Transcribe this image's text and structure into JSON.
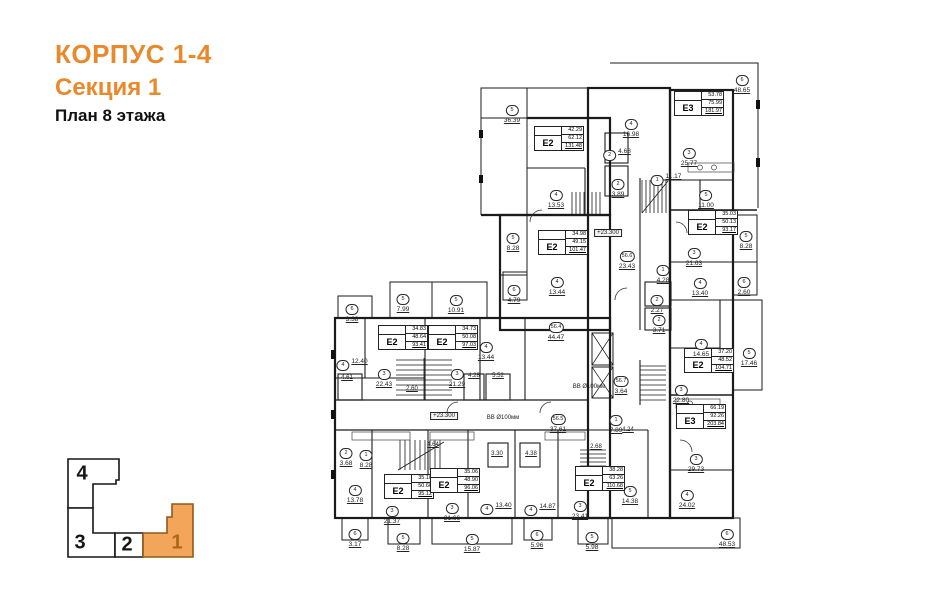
{
  "header": {
    "building": "КОРПУС 1-4",
    "section": "Секция 1",
    "floor": "План 8 этажа"
  },
  "colors": {
    "accent": "#e8892c",
    "key_active_fill": "#f3a55a",
    "key_active_stroke": "#8f5a1b",
    "key_active_text": "#a8691e",
    "line": "#1b1b1b"
  },
  "key_plan": {
    "sections": [
      {
        "label": "4",
        "active": false
      },
      {
        "label": "3",
        "active": false
      },
      {
        "label": "2",
        "active": false
      },
      {
        "label": "1",
        "active": true
      }
    ]
  },
  "plan": {
    "units": [
      {
        "label": "E2",
        "rows": [
          "42.29",
          "62.12",
          "131.48"
        ],
        "x": 534,
        "y": 126
      },
      {
        "label": "E3",
        "rows": [
          "53.78",
          "75.99",
          "181.97"
        ],
        "x": 674,
        "y": 91
      },
      {
        "label": "E2",
        "rows": [
          "35.03",
          "50.13",
          "93.17"
        ],
        "x": 688,
        "y": 210
      },
      {
        "label": "E2",
        "rows": [
          "34.98",
          "49.15",
          "101.47"
        ],
        "x": 538,
        "y": 230
      },
      {
        "label": "E2",
        "rows": [
          "37.20",
          "48.52",
          "104.71"
        ],
        "x": 684,
        "y": 348
      },
      {
        "label": "E3",
        "rows": [
          "66.19",
          "92.26",
          "203.84"
        ],
        "x": 676,
        "y": 404
      },
      {
        "label": "E2",
        "rows": [
          "34.83",
          "48.64",
          "93.41"
        ],
        "x": 378,
        "y": 325
      },
      {
        "label": "E2",
        "rows": [
          "34.73",
          "50.08",
          "97.03"
        ],
        "x": 428,
        "y": 325
      },
      {
        "label": "E2",
        "rows": [
          "35.10",
          "50.66",
          "95.12"
        ],
        "x": 384,
        "y": 474
      },
      {
        "label": "E2",
        "rows": [
          "35.06",
          "48.90",
          "96.06"
        ],
        "x": 430,
        "y": 468
      },
      {
        "label": "E2",
        "rows": [
          "38.28",
          "63.26",
          "110.68"
        ],
        "x": 575,
        "y": 466
      }
    ],
    "labels": [
      {
        "t": "s",
        "n": "5",
        "v": "36.39",
        "x": 512,
        "y": 98
      },
      {
        "t": "s",
        "n": "4",
        "v": "13.53",
        "x": 556,
        "y": 183
      },
      {
        "t": "i",
        "n": "2",
        "v": "4.68",
        "x": 617,
        "y": 143
      },
      {
        "t": "s",
        "n": "2",
        "v": "3.89",
        "x": 618,
        "y": 172
      },
      {
        "t": "s",
        "n": "4",
        "v": "16.98",
        "x": 631,
        "y": 112
      },
      {
        "t": "s",
        "n": "3",
        "v": "25.77",
        "x": 689,
        "y": 141
      },
      {
        "t": "i",
        "n": "1",
        "v": "11.17",
        "x": 666,
        "y": 168
      },
      {
        "t": "s",
        "n": "5",
        "v": "11.00",
        "x": 706,
        "y": 183
      },
      {
        "t": "s",
        "n": "6",
        "v": "48.65",
        "x": 742,
        "y": 68
      },
      {
        "t": "s",
        "n": "5",
        "v": "8.28",
        "x": 746,
        "y": 224
      },
      {
        "t": "s",
        "n": "6",
        "v": "2.60",
        "x": 744,
        "y": 270
      },
      {
        "t": "s",
        "n": "3",
        "v": "21.63",
        "x": 694,
        "y": 241
      },
      {
        "t": "s",
        "n": "4",
        "v": "13.40",
        "x": 700,
        "y": 271
      },
      {
        "t": "s",
        "n": "5",
        "v": "8.28",
        "x": 513,
        "y": 226
      },
      {
        "t": "s",
        "n": "6",
        "v": "4.79",
        "x": 514,
        "y": 278
      },
      {
        "t": "s",
        "n": "4",
        "v": "13.44",
        "x": 557,
        "y": 270
      },
      {
        "t": "s",
        "n": "56.4",
        "v": "44.47",
        "x": 556,
        "y": 315
      },
      {
        "t": "s",
        "n": "56.6",
        "v": "23.43",
        "x": 627,
        "y": 244
      },
      {
        "t": "s",
        "n": "1",
        "v": "4.28",
        "x": 663,
        "y": 258
      },
      {
        "t": "s",
        "n": "2",
        "v": "2.27",
        "x": 657,
        "y": 288
      },
      {
        "t": "s",
        "n": "2",
        "v": "3.71",
        "x": 659,
        "y": 308
      },
      {
        "t": "s",
        "n": "4",
        "v": "14.65",
        "x": 701,
        "y": 332
      },
      {
        "t": "s",
        "n": "3",
        "v": "22.80",
        "x": 681,
        "y": 378
      },
      {
        "t": "s",
        "n": "5",
        "v": "17.46",
        "x": 749,
        "y": 341
      },
      {
        "t": "s",
        "n": "56.7",
        "v": "3.64",
        "x": 621,
        "y": 369
      },
      {
        "t": "s",
        "n": "56.5",
        "v": "37.61",
        "x": 558,
        "y": 407
      },
      {
        "t": "s",
        "n": "3",
        "v": "29.73",
        "x": 696,
        "y": 447
      },
      {
        "t": "s",
        "n": "4",
        "v": "24.02",
        "x": 687,
        "y": 483
      },
      {
        "t": "s",
        "n": "6",
        "v": "48.53",
        "x": 727,
        "y": 522
      },
      {
        "t": "s",
        "n": "6",
        "v": "3.38",
        "x": 352,
        "y": 297
      },
      {
        "t": "s",
        "n": "5",
        "v": "7.99",
        "x": 403,
        "y": 287
      },
      {
        "t": "s",
        "n": "5",
        "v": "10.91",
        "x": 456,
        "y": 288
      },
      {
        "t": "i",
        "n": "4",
        "v": "12.40",
        "x": 352,
        "y": 353
      },
      {
        "t": "s",
        "n": "3",
        "v": "22.43",
        "x": 384,
        "y": 362
      },
      {
        "t": "p",
        "n": "",
        "v": "4.61",
        "x": 347,
        "y": 374
      },
      {
        "t": "s",
        "n": "3",
        "v": "21.29",
        "x": 457,
        "y": 362
      },
      {
        "t": "p",
        "n": "",
        "v": "4.28",
        "x": 474,
        "y": 372
      },
      {
        "t": "p",
        "n": "",
        "v": "5.52",
        "x": 498,
        "y": 372
      },
      {
        "t": "s",
        "n": "4",
        "v": "13.44",
        "x": 486,
        "y": 335
      },
      {
        "t": "p",
        "n": "",
        "v": "2.60",
        "x": 412,
        "y": 385
      },
      {
        "t": "b",
        "n": "",
        "v": "+23.300",
        "x": 444,
        "y": 412
      },
      {
        "t": "n",
        "n": "",
        "v": "ВВ Ø100мм",
        "x": 503,
        "y": 414
      },
      {
        "t": "b",
        "n": "",
        "v": "+23.300",
        "x": 608,
        "y": 229
      },
      {
        "t": "n",
        "n": "",
        "v": "ВВ Ø100мм",
        "x": 589,
        "y": 383
      },
      {
        "t": "s",
        "n": "2",
        "v": "3.68",
        "x": 346,
        "y": 441
      },
      {
        "t": "s",
        "n": "1",
        "v": "8.28",
        "x": 366,
        "y": 443
      },
      {
        "t": "s",
        "n": "4",
        "v": "13.78",
        "x": 355,
        "y": 478
      },
      {
        "t": "s",
        "n": "3",
        "v": "21.37",
        "x": 392,
        "y": 499
      },
      {
        "t": "s",
        "n": "3",
        "v": "21.66",
        "x": 452,
        "y": 496
      },
      {
        "t": "i",
        "n": "4",
        "v": "13.40",
        "x": 496,
        "y": 497
      },
      {
        "t": "i",
        "n": "4",
        "v": "14.87",
        "x": 540,
        "y": 498
      },
      {
        "t": "s",
        "n": "3",
        "v": "23.41",
        "x": 580,
        "y": 494
      },
      {
        "t": "s",
        "n": "5",
        "v": "14.38",
        "x": 630,
        "y": 479
      },
      {
        "t": "s",
        "n": "6",
        "v": "3.17",
        "x": 355,
        "y": 522
      },
      {
        "t": "s",
        "n": "5",
        "v": "8.28",
        "x": 403,
        "y": 526
      },
      {
        "t": "s",
        "n": "5",
        "v": "15.87",
        "x": 472,
        "y": 527
      },
      {
        "t": "s",
        "n": "6",
        "v": "5.96",
        "x": 537,
        "y": 523
      },
      {
        "t": "s",
        "n": "5",
        "v": "5.98",
        "x": 592,
        "y": 525
      },
      {
        "t": "p",
        "n": "",
        "v": "2.68",
        "x": 596,
        "y": 443
      },
      {
        "t": "s",
        "n": "1",
        "v": "7.89",
        "x": 616,
        "y": 408
      },
      {
        "t": "p",
        "n": "",
        "v": "4.24",
        "x": 628,
        "y": 426
      },
      {
        "t": "p",
        "n": "",
        "v": "3.30",
        "x": 497,
        "y": 450
      },
      {
        "t": "p",
        "n": "",
        "v": "4.38",
        "x": 531,
        "y": 450
      },
      {
        "t": "p",
        "n": "",
        "v": "4.64",
        "x": 433,
        "y": 441
      }
    ]
  }
}
